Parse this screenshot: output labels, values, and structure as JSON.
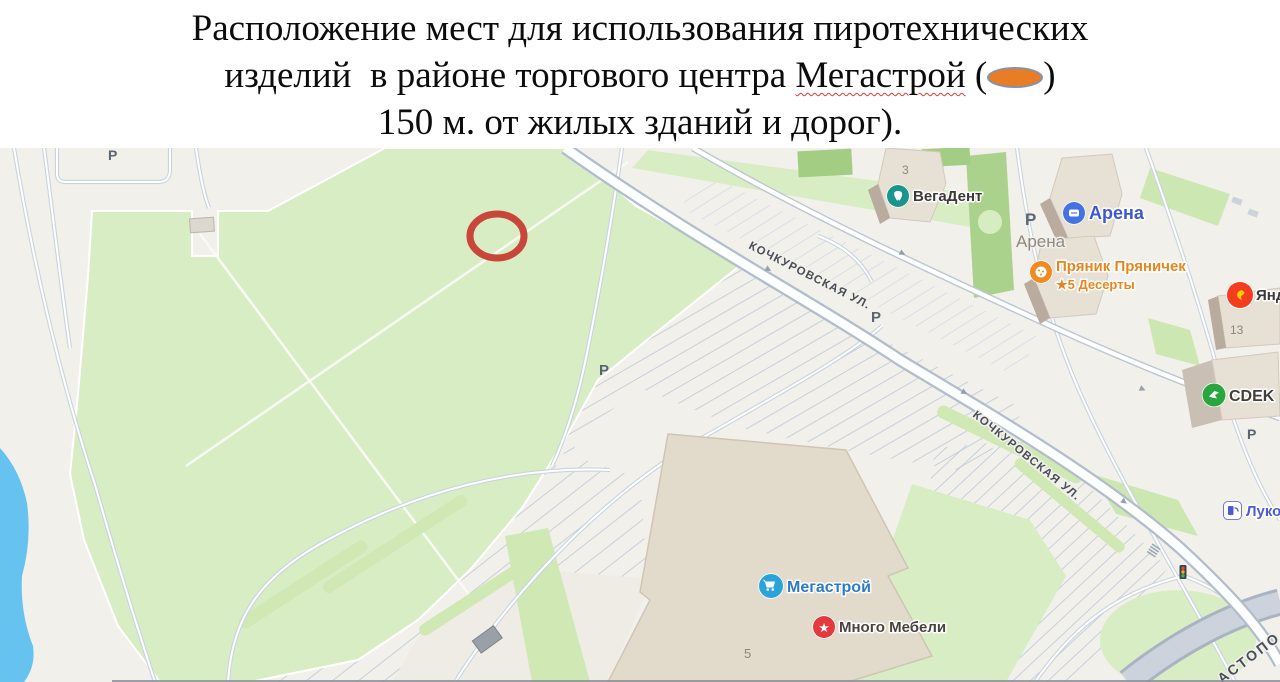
{
  "title": {
    "line1": "Расположение мест для использования пиротехнических",
    "line2_before": "изделий  в районе торгового центра ",
    "line2_brand": "Мегастрой",
    "line2_open": " (",
    "line2_close": ")",
    "line3": "150 м. от жилых зданий и дорог).",
    "marker": {
      "fill": "#e87d26",
      "border": "#8493ad"
    }
  },
  "map": {
    "provider_style": "yandex-maps-light",
    "parking_letter": "Р",
    "streets": {
      "kochurovskaya": "КОЧКУРОВСКАЯ УЛ.",
      "corner_partial": "АСТОПО"
    },
    "building_numbers": {
      "vegadent": "3",
      "yandex": "13",
      "megastroy": "5"
    },
    "pois": [
      {
        "id": "vegadent",
        "label": "ВегаДент",
        "icon_color": "#18968b",
        "label_color": "#3c3836"
      },
      {
        "id": "arena",
        "label": "Арена",
        "icon_color": "#4472e4",
        "label_color": "#3d56d6"
      },
      {
        "id": "arena-area",
        "label": "Арена",
        "label_color": "#8e8880"
      },
      {
        "id": "pryanik",
        "label": "Пряник Пряничек",
        "sublabel": "★5 Десерты",
        "icon_color": "#f08a21",
        "label_color": "#e8861d"
      },
      {
        "id": "yandex",
        "label": "Яндекс",
        "icon_color": "#f43c1e",
        "label_color": "#3c3836"
      },
      {
        "id": "cdek",
        "label": "CDEK",
        "icon_color": "#29a63d",
        "label_color": "#453f3a"
      },
      {
        "id": "lukoil",
        "label": "Лукойл",
        "icon_color": "#4a5cd0",
        "label_color": "#4a5cd0"
      },
      {
        "id": "megastroy",
        "label": "Мегастрой",
        "icon_color": "#2aa3da",
        "label_color": "#2a7cc9"
      },
      {
        "id": "mnogo-mebeli",
        "label": "Много Мебели",
        "icon_color": "#e23a3e",
        "label_color": "#4a423d"
      }
    ],
    "annotation": {
      "shape": "ellipse-outline",
      "stroke_color": "#c9463a"
    }
  }
}
